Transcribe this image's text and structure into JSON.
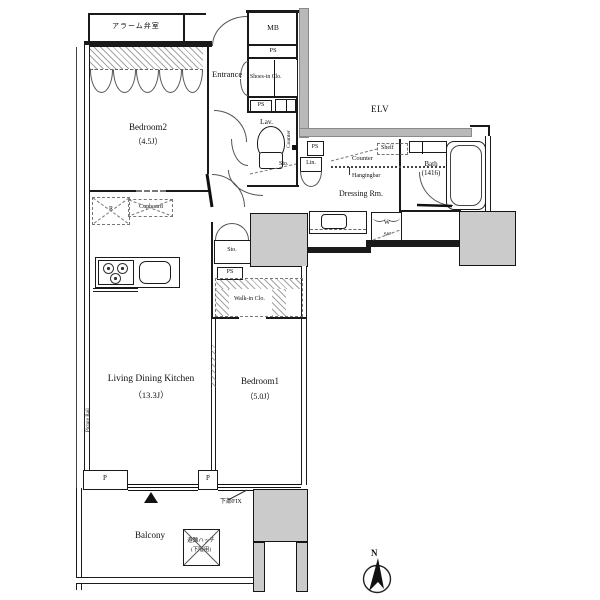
{
  "title": "apartment-floor-plan",
  "colors": {
    "wall": "#1a1a1a",
    "gray_fill": "#cbcbcb",
    "corridor_fill": "#b9b9b9"
  },
  "labels": {
    "alarm_room": "アラーム弁室",
    "mb": "MB",
    "ps": "PS",
    "entrance": "Entrance",
    "shoes_in_clo": "Shoes-in Clo.",
    "lav": "Lav.",
    "counter": "Counter",
    "sto": "Sto.",
    "elv": "ELV",
    "lin": "Lin.",
    "shelf": "Shelf",
    "hangingbar": "Hangingbar",
    "dressing_rm": "Dressing Rm.",
    "bath": "Bath",
    "bath_size": "(1416)",
    "washer": "W",
    "walk_in_clo": "Walk-in Clo.",
    "bedroom2": "Bedroom2",
    "bedroom2_size": "（4.5J）",
    "bedroom1": "Bedroom1",
    "bedroom1_size": "（5.0J）",
    "ldk": "Living Dining Kitchen",
    "ldk_size": "（13.3J）",
    "refrigerator": "R",
    "cupboard": "Cupboard",
    "picture_rail": "Picture Rail",
    "balcony": "Balcony",
    "hatch_line1": "避難ハッチ",
    "hatch_line2": "(下階用)",
    "pillar": "P",
    "fix": "下部FIX",
    "compass_n": "N"
  }
}
